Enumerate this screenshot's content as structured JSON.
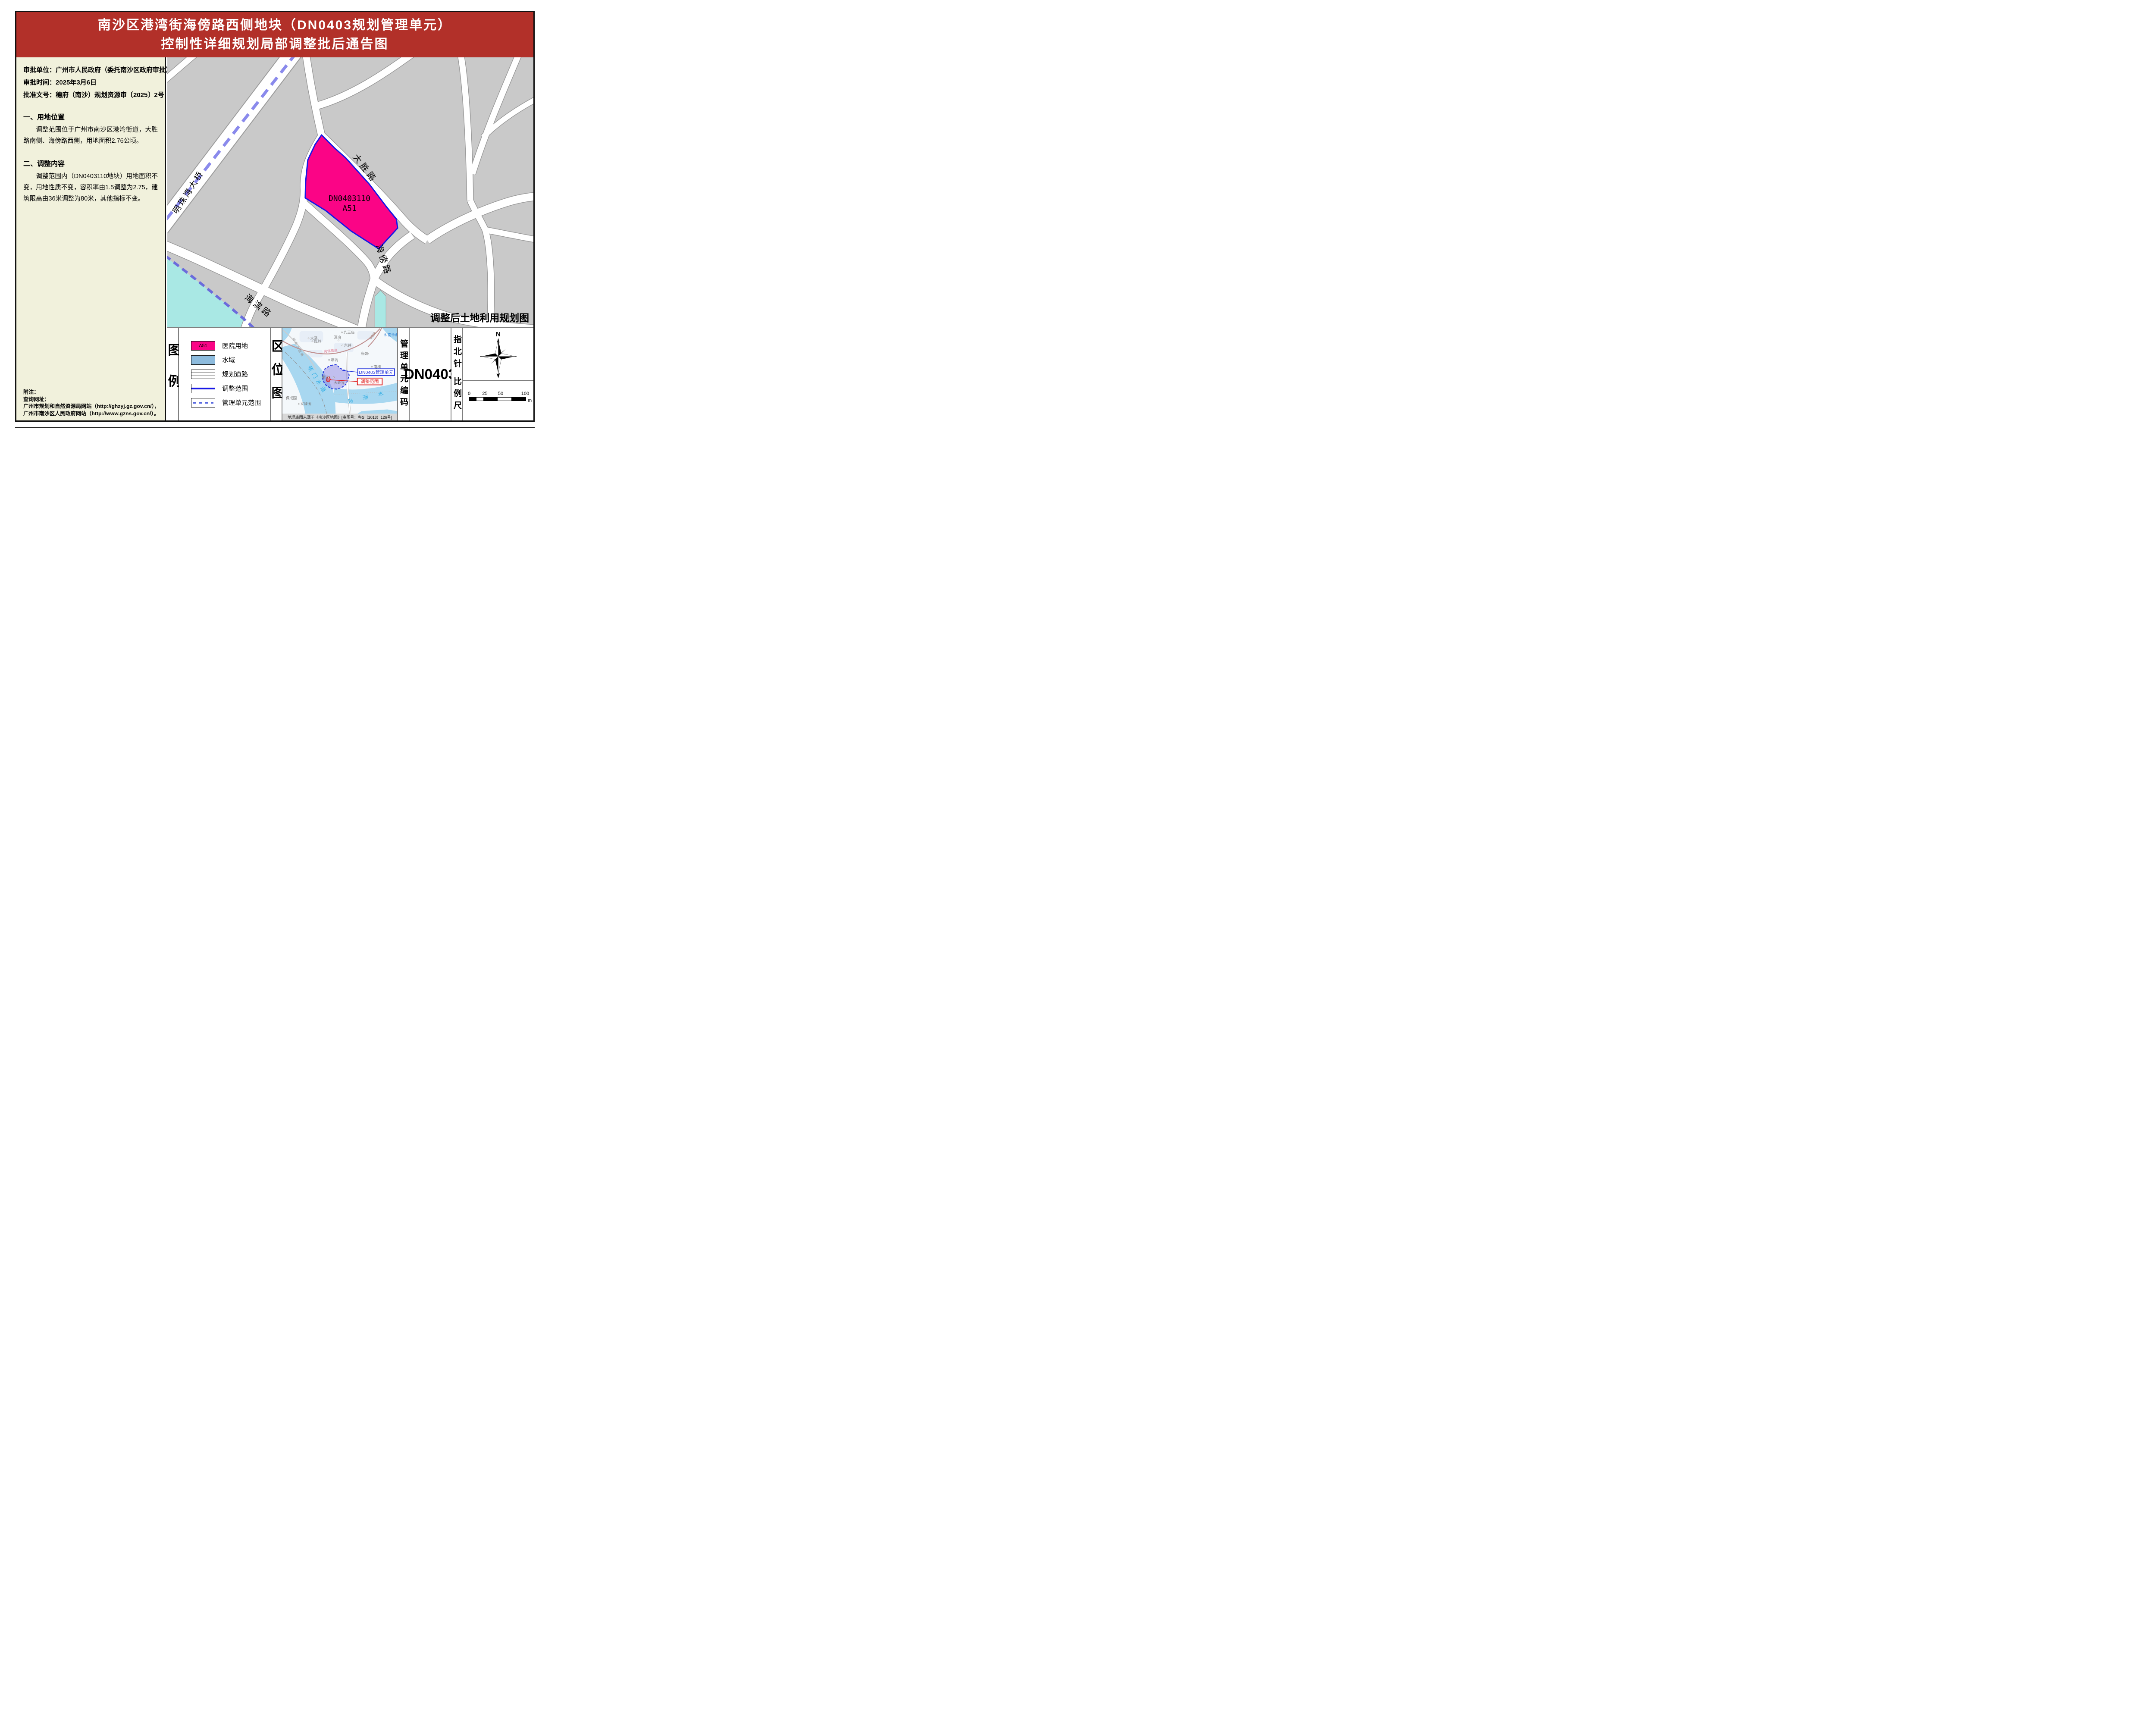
{
  "title": {
    "line1": "南沙区港湾街海傍路西侧地块（DN0403规划管理单元）",
    "line2": "控制性详细规划局部调整批后通告图"
  },
  "info": {
    "approval_unit": "审批单位：广州市人民政府（委托南沙区政府审批）",
    "approval_time": "审批时间：2025年3月6日",
    "approval_doc": "批准文号：穗府（南沙）规划资源审〔2025〕2号"
  },
  "sections": {
    "s1_title": "一、用地位置",
    "s1_body": "调整范围位于广州市南沙区港湾街道，大胜路南侧、海傍路西侧，用地面积2.76公顷。",
    "s2_title": "二、调整内容",
    "s2_body": "调整范围内（DN0403110地块）用地面积不变，用地性质不变，容积率由1.5调整为2.75，建筑限高由36米调整为80米，其他指标不变。"
  },
  "notes": {
    "line1": "附注：",
    "line2": "查询网址：",
    "line3": "广州市规划和自然资源局网站（http://ghzyj.gz.gov.cn/），",
    "line4": "广州市南沙区人民政府网站（http://www.gzns.gov.cn/）。"
  },
  "map": {
    "parcel_code": "DN0403110",
    "parcel_use": "A51",
    "caption": "调整后土地利用规划图",
    "roads": {
      "dasheng": "大胜路",
      "haipang": "海傍路",
      "haibin": "海滨路",
      "mingzhuwan": "明珠湾大桥"
    }
  },
  "legend": {
    "heading": "图例",
    "items": [
      {
        "code": "A51",
        "label": "医院用地"
      },
      {
        "code": "",
        "label": "水域"
      },
      {
        "code": "",
        "label": "规划道路"
      },
      {
        "code": "",
        "label": "调整范围"
      },
      {
        "code": "",
        "label": "管理单元范围"
      }
    ]
  },
  "location_map": {
    "heading": "区位图",
    "callout_unit": "DN0403管理单元",
    "callout_scope": "调整范围",
    "rivers": {
      "jiaomen": "蕉门水道",
      "fuzhou": "凫 洲 水"
    },
    "roads": {
      "wanfo": "莞佛高速",
      "g228": "G228",
      "huanshi": "环市大道南"
    },
    "port": "南沙港",
    "places": {
      "jiuwangmiao": "九王庙",
      "hongling": "红岭",
      "dayong": "大涌",
      "shenwan": "深湾",
      "dongjing": "东井",
      "tangkeng": "塘坑",
      "lujing": "鹿颈",
      "nanheng": "南横",
      "nansha": "南沙",
      "dalingjie": "大岭界",
      "baochengwei": "保成围",
      "yilongwei": "义隆围"
    },
    "caption": "地理底图来源于《南沙区地图》[审图号：粤S（2018）126号]"
  },
  "unit_code": {
    "heading": "管理单元编码",
    "value": "DN0403"
  },
  "compass": {
    "heading": "指北针",
    "north": "N"
  },
  "scalebar": {
    "heading": "比例尺",
    "ticks": [
      "0",
      "25",
      "50",
      "100"
    ],
    "unit": "m"
  },
  "colors": {
    "title_band": "#b23029",
    "panel_beige": "#f1f1dc",
    "block_gray": "#c9c9c9",
    "road_casing": "#9a9a9a",
    "parcel_fill": "#fb0486",
    "parcel_border": "#1717e6",
    "bridge_dash": "#8a8aec",
    "water_main_map": "#a9e8e4",
    "water_border_dash": "#6b6bdc",
    "water_inset": "#a8d7f0",
    "legend_water": "#8dbbdd",
    "unit_dash_blue": "#2233dd",
    "scope_red": "#dd1111"
  }
}
